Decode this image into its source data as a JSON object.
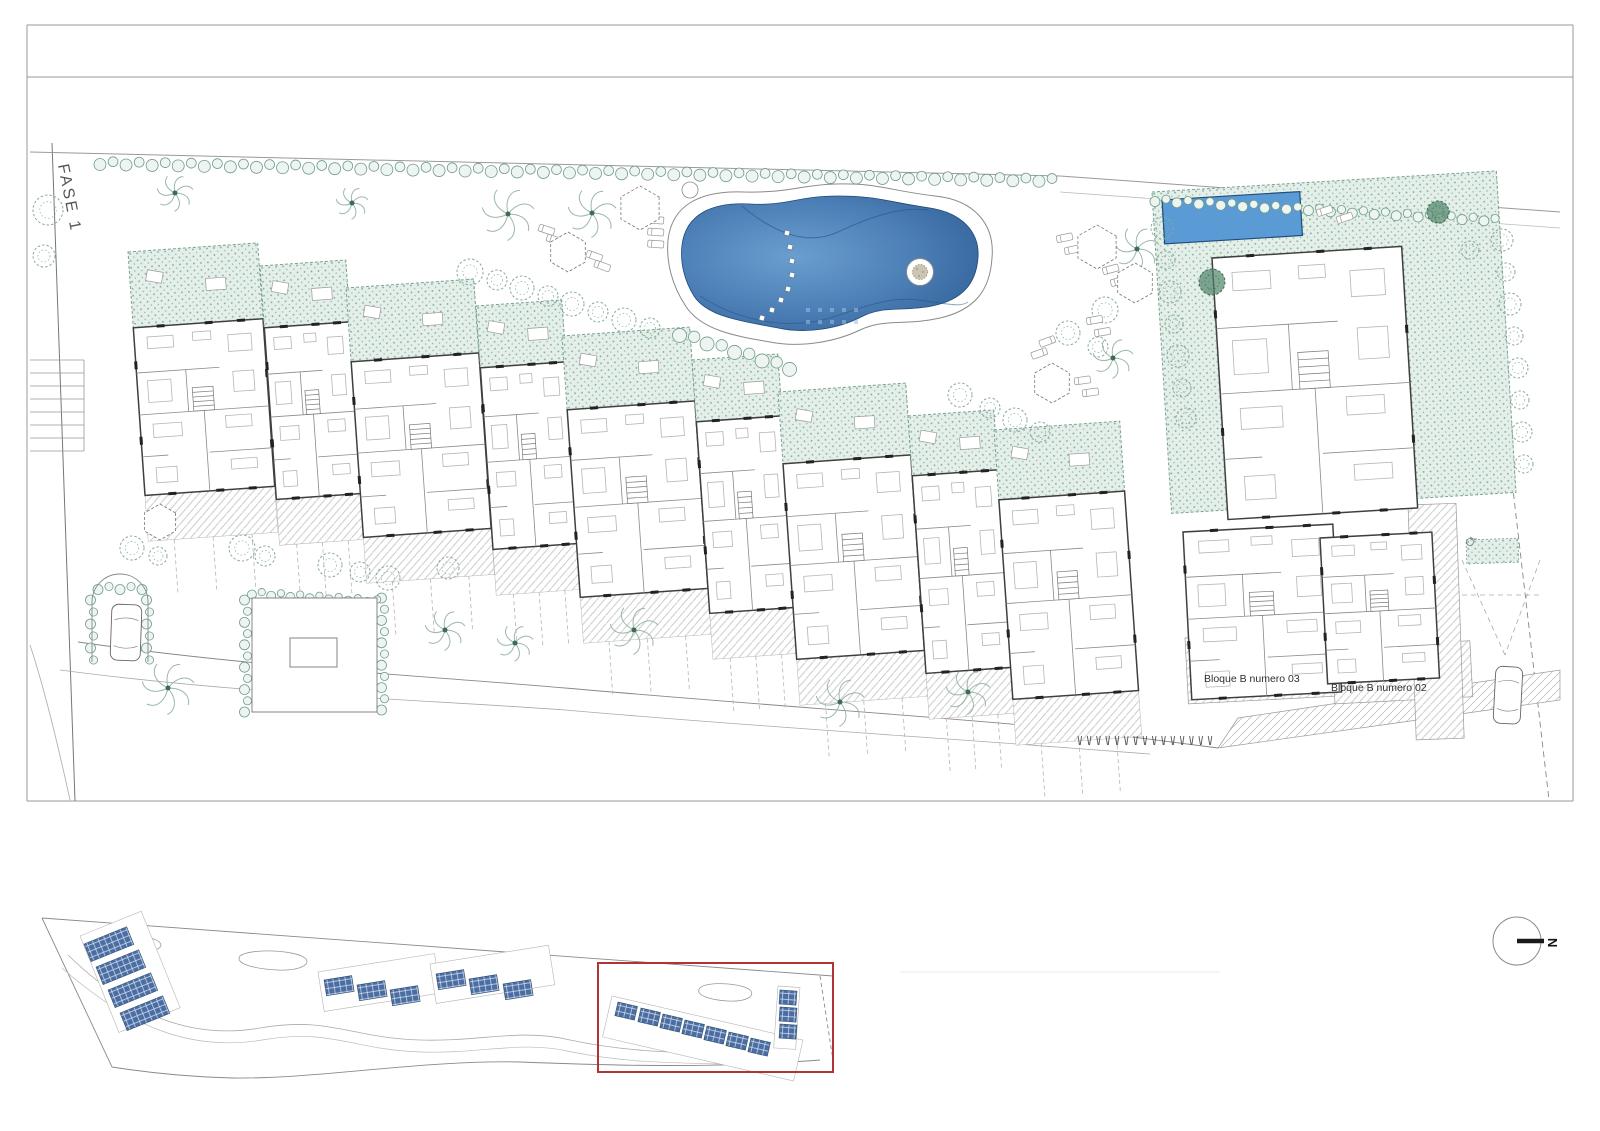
{
  "drawing": {
    "phase_label": "FASE 1",
    "building_labels": {
      "bloque_03": "Bloque B numero 03",
      "bloque_02": "Bloque B numero 02"
    },
    "north_label": "N",
    "colors": {
      "pool_center": "#6b9ecf",
      "pool_mid": "#4a7db4",
      "pool_edge": "#2d5c92",
      "small_pool": "#5b9bd5",
      "garden_fill": "#e3efe8",
      "garden_dot": "#7fa794",
      "hedge": "#6f9c8c",
      "hedge_fill": "#eef4f0",
      "tree": "#86ab9b",
      "tree_dark": "#4f8468",
      "wall": "#3f3f3f",
      "line": "#8a8a8a",
      "furniture": "#b5b5b5",
      "hatch": "#c2c2c2",
      "overview_panel": "#4a6da3",
      "highlight": "#b03434"
    }
  }
}
